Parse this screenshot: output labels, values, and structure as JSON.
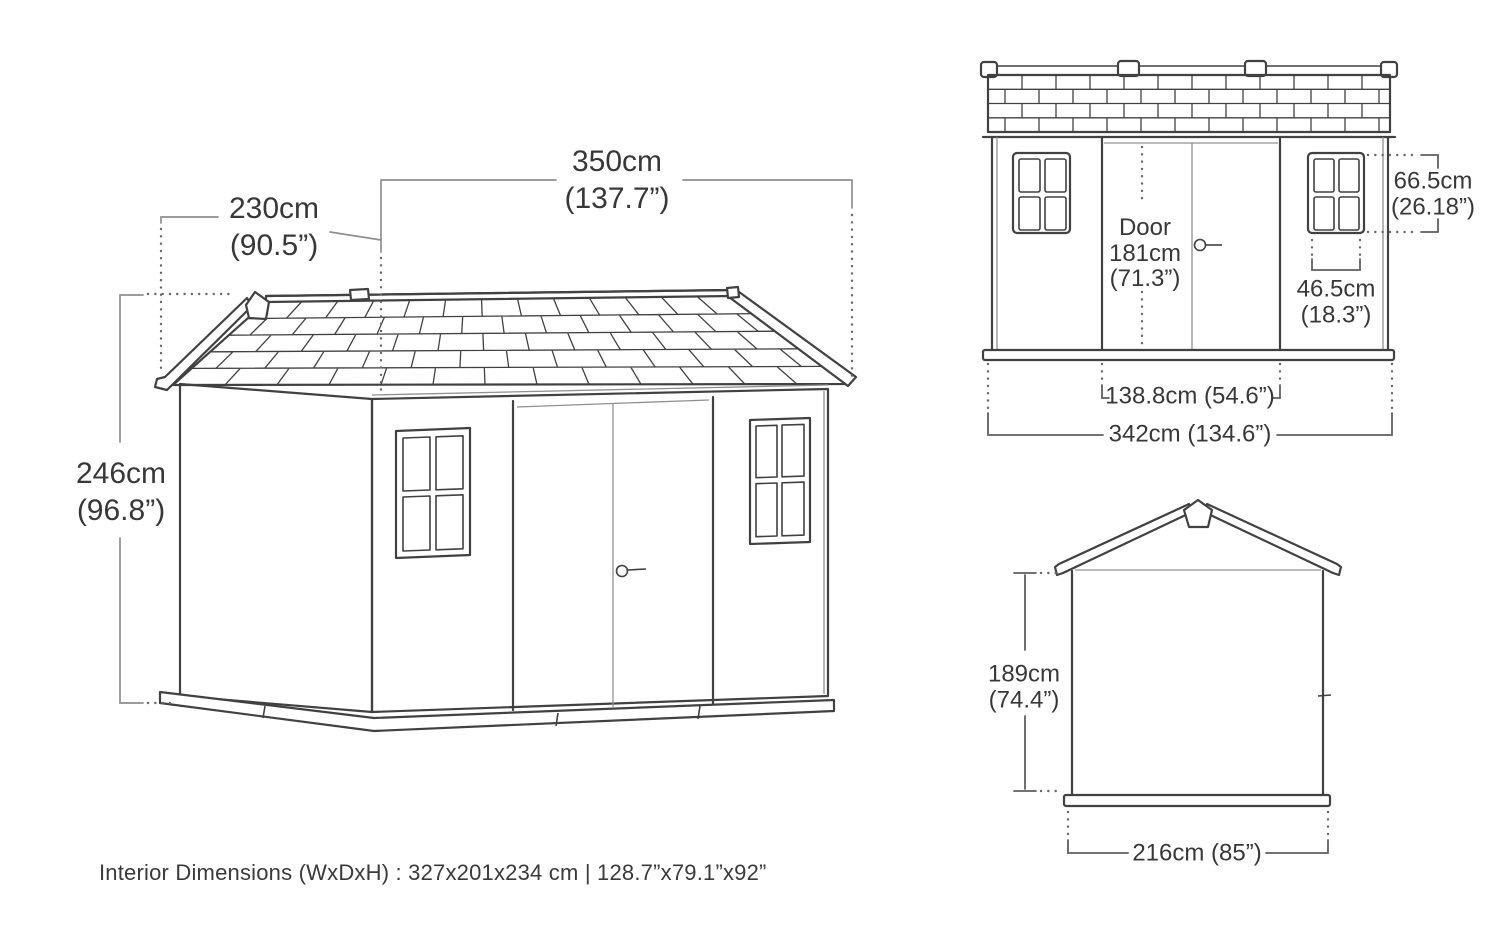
{
  "perspective_view": {
    "depth": {
      "cm": "230cm",
      "inches": "(90.5”)"
    },
    "width": {
      "cm": "350cm",
      "inches": "(137.7”)"
    },
    "height": {
      "cm": "246cm",
      "inches": "(96.8”)"
    }
  },
  "front_elevation": {
    "door": {
      "label": "Door",
      "cm": "181cm",
      "inches": "(71.3”)"
    },
    "window_height": {
      "cm": "66.5cm",
      "inches": "(26.18”)"
    },
    "window_width": {
      "cm": "46.5cm",
      "inches": "(18.3”)"
    },
    "door_span": "138.8cm (54.6”)",
    "overall_width": "342cm (134.6”)"
  },
  "side_elevation": {
    "wall_height": {
      "cm": "189cm",
      "inches": "(74.4”)"
    },
    "base_width": "216cm (85”)"
  },
  "footer": {
    "interior_dimensions": "Interior Dimensions (WxDxH) : 327x201x234 cm | 128.7”x79.1”x92”"
  },
  "colors": {
    "line": "#414141",
    "dim_line": "#8f8f8f",
    "text": "#383838",
    "background": "#ffffff"
  }
}
